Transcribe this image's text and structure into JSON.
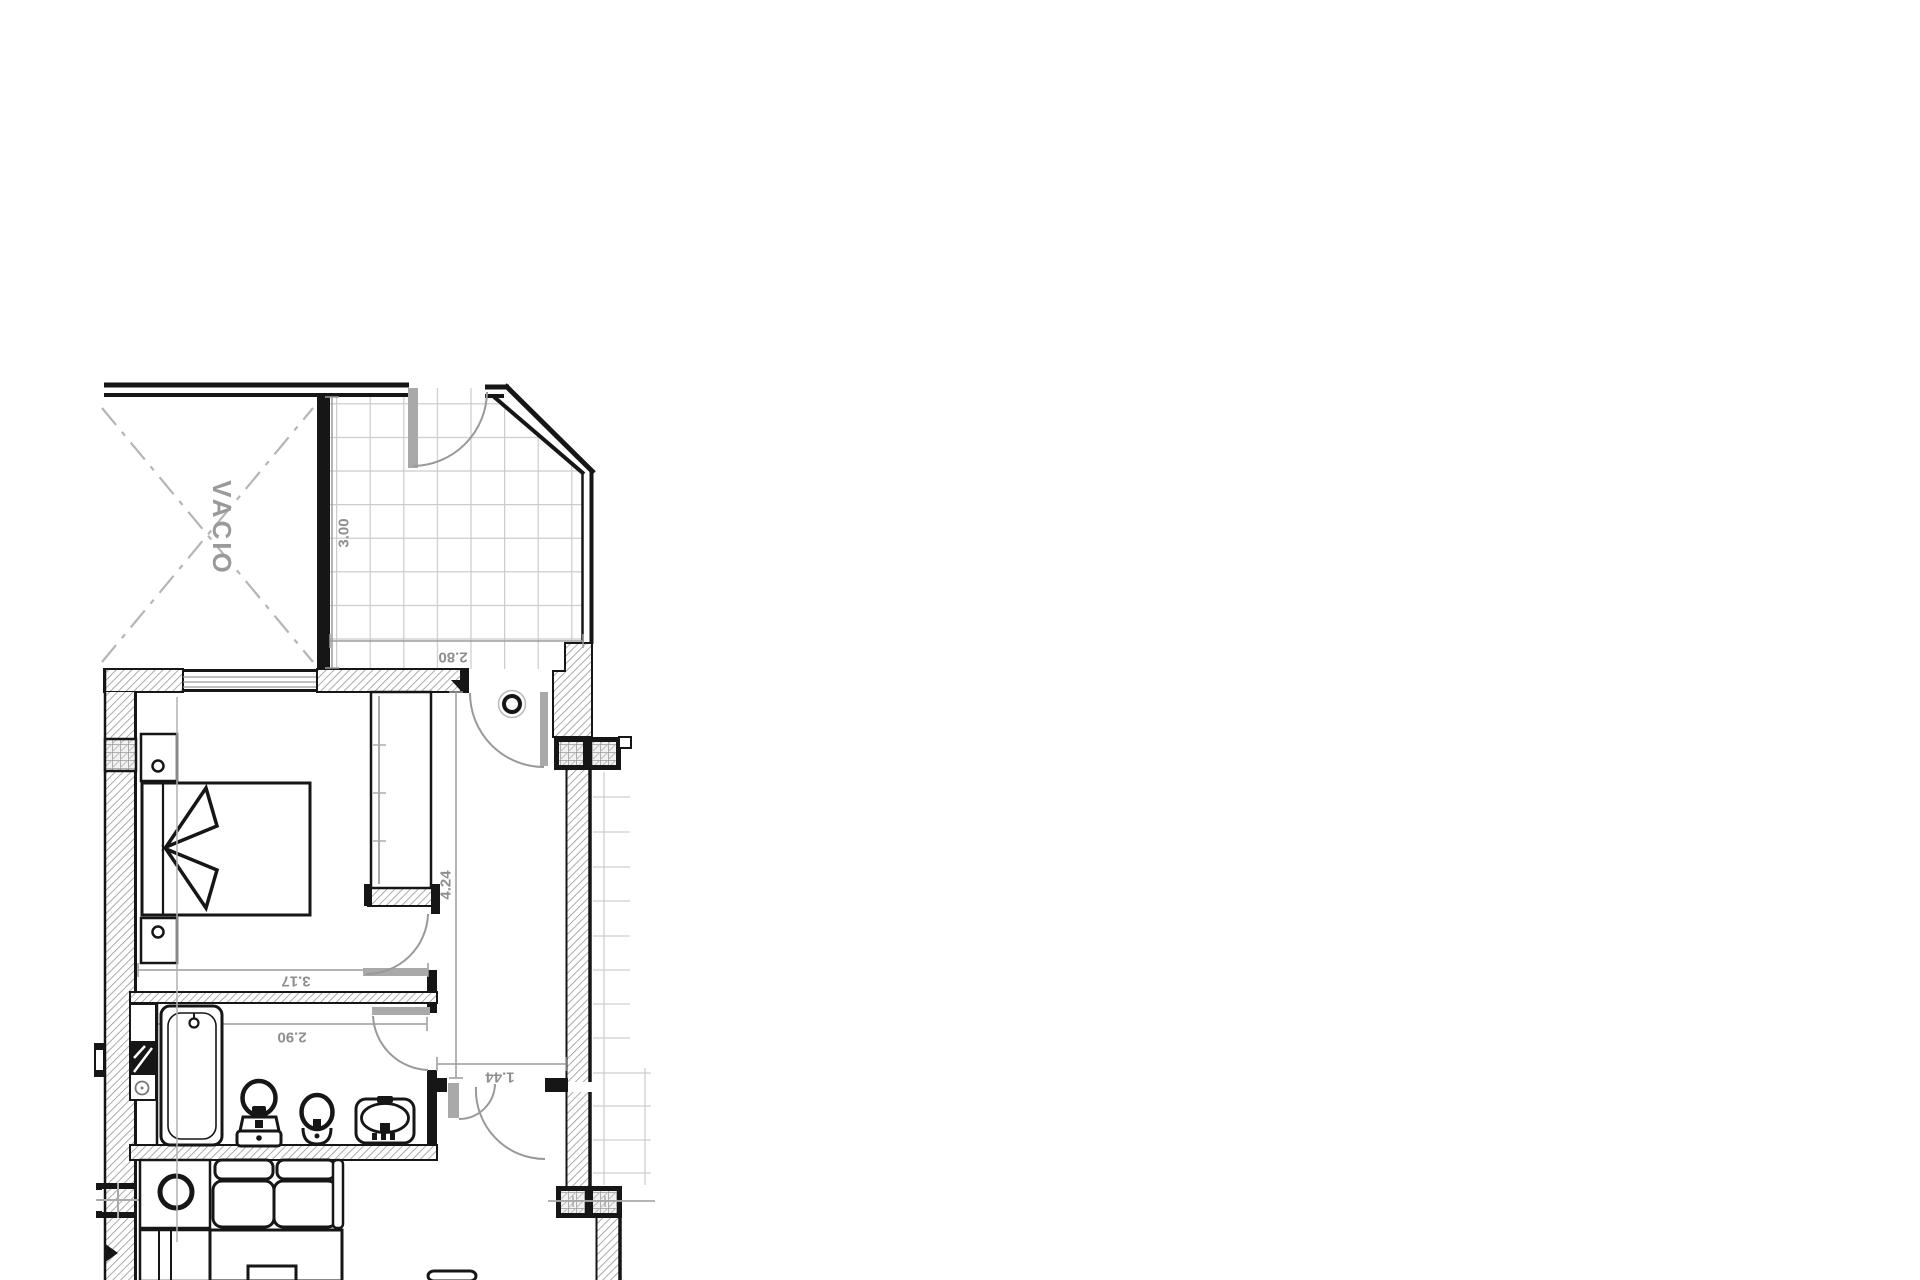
{
  "document": {
    "type": "architectural floor plan",
    "background": "#ffffff"
  },
  "rooms": {
    "void_label": "VACIO"
  },
  "dimensions": {
    "terrace_depth": "3.00",
    "terrace_width": "2.80",
    "bedroom_width": "3.17",
    "bedroom_depth": "2.05",
    "bathroom_width": "2.90",
    "hall_width": "1.44",
    "hall_length": "4.24"
  },
  "colors": {
    "line": "#161616",
    "wall_hatch": "#8f8f8f",
    "dimension": "#8e8e8e",
    "tile_grid": "#cccccc",
    "door_leaf": "#a9a9a9",
    "void_dash": "#b5b5b5"
  }
}
